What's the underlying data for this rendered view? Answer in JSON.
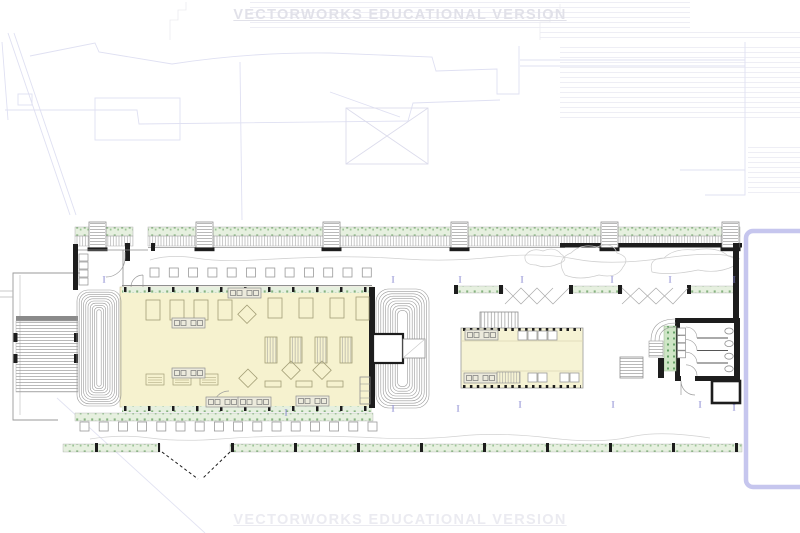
{
  "document": {
    "type": "architectural-floor-plan",
    "application_watermark": "VECTORWORKS EDUCATIONAL VERSION"
  },
  "watermarks": {
    "top": "VECTORWORKS EDUCATIONAL VERSION",
    "bottom": "VECTORWORKS EDUCATIONAL VERSION"
  },
  "markers": {
    "glyph": "I",
    "color": "#7d7dcc",
    "positions": [
      {
        "x": 104,
        "y": 281
      },
      {
        "x": 393,
        "y": 281
      },
      {
        "x": 460,
        "y": 281
      },
      {
        "x": 522,
        "y": 281
      },
      {
        "x": 612,
        "y": 281
      },
      {
        "x": 670,
        "y": 281
      },
      {
        "x": 734,
        "y": 281
      },
      {
        "x": 286,
        "y": 414
      },
      {
        "x": 393,
        "y": 410
      },
      {
        "x": 458,
        "y": 410
      },
      {
        "x": 520,
        "y": 406
      },
      {
        "x": 613,
        "y": 406
      },
      {
        "x": 700,
        "y": 406
      },
      {
        "x": 734,
        "y": 409
      }
    ]
  },
  "palette": {
    "hall_fill": "#f6f2cf",
    "pavilion_fill": "#f6f3d4",
    "planting_fill": "#e6f0df",
    "planting_dot": "#86b37f",
    "wall_black": "#1d1d1d",
    "line_gray": "#8f8f8f",
    "line_light": "#c9c9c9",
    "context_lavender": "#dfe0f2",
    "context_gray": "#ebebf0",
    "viewport_border": "#c6c6ee",
    "marker_purple": "#7d7dcc",
    "watermark_top": "#e1e1e9",
    "watermark_bottom": "#ebebf1"
  }
}
